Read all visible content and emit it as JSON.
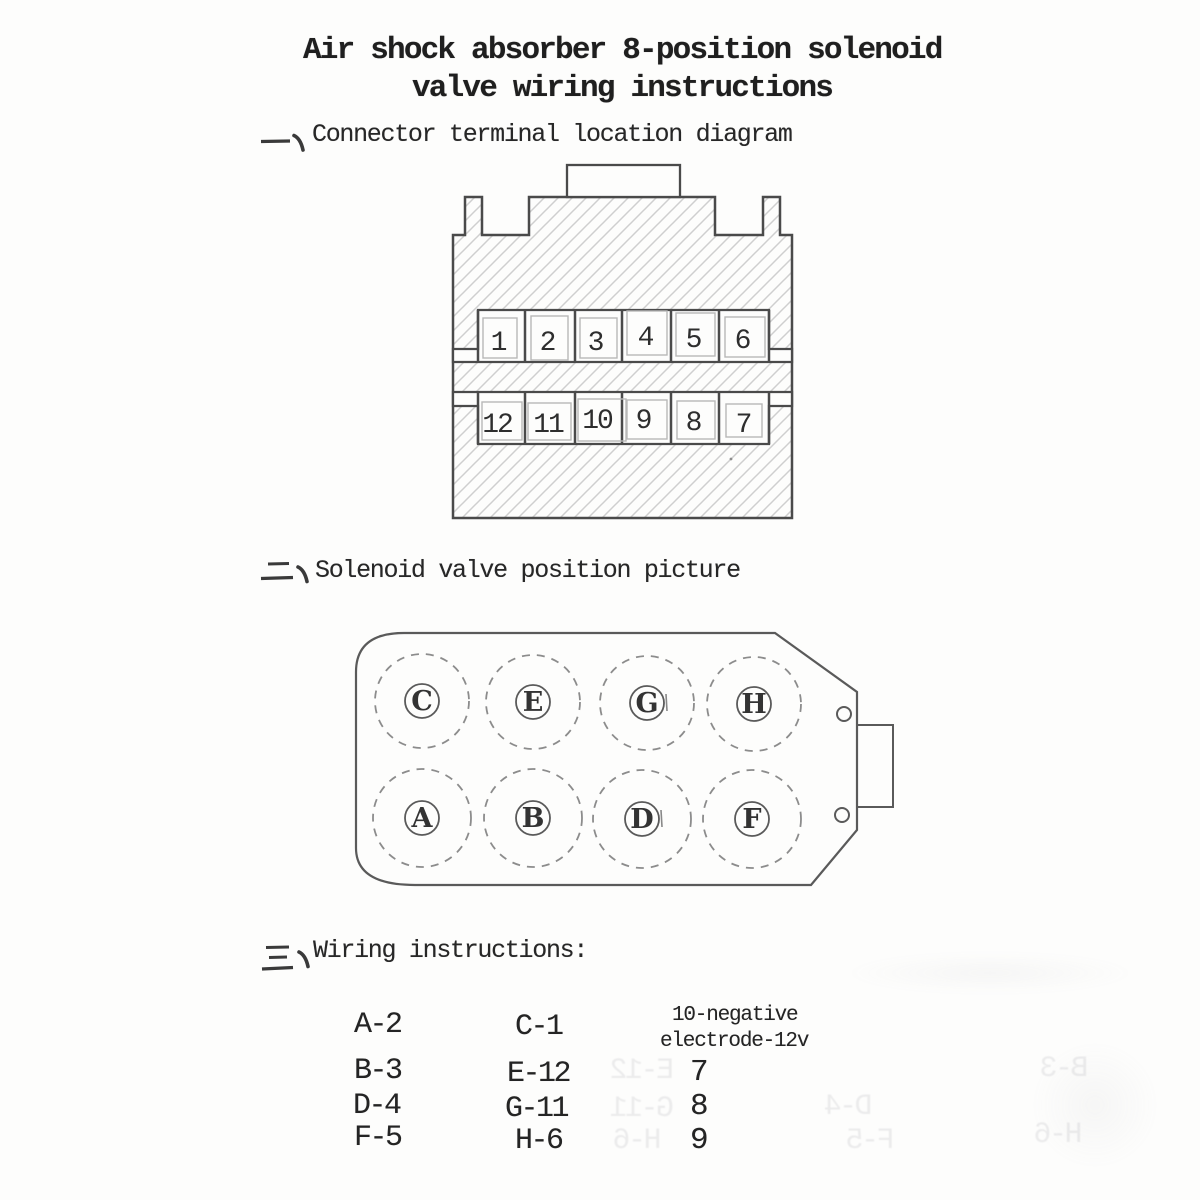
{
  "document": {
    "title_line1": "Air shock absorber 8-position solenoid",
    "title_line2": "valve wiring instructions"
  },
  "sections": {
    "one": {
      "marker": "一、",
      "heading": "Connector terminal location diagram"
    },
    "two": {
      "marker": "二、",
      "heading": "Solenoid valve position picture"
    },
    "three": {
      "marker": "三、",
      "heading": "Wiring instructions:"
    }
  },
  "connector": {
    "top_row": [
      "1",
      "2",
      "3",
      "4",
      "5",
      "6"
    ],
    "bottom_row": [
      "12",
      "11",
      "10",
      "9",
      "8",
      "7"
    ]
  },
  "solenoid": {
    "top_row": [
      "C",
      "E",
      "G",
      "H"
    ],
    "bottom_row": [
      "A",
      "B",
      "D",
      "F"
    ]
  },
  "wiring": {
    "col1": [
      "A-2",
      "B-3",
      "D-4",
      "F-5"
    ],
    "col2": [
      "C-1",
      "E-12",
      "G-11",
      "H-6"
    ],
    "note_line1": "10-negative",
    "note_line2": "electrode-12v",
    "col3": [
      "7",
      "8",
      "9"
    ]
  },
  "artifacts": {
    "bleed": [
      "E-12",
      "G-11",
      "H-6",
      "D-4",
      "F-5",
      "B-3",
      "H-6"
    ]
  },
  "colors": {
    "ink": "#262626",
    "outline": "#4a4a4a",
    "solenoid_outline": "#5a5a5a",
    "hatch": "#cfcfcf",
    "inner_box": "#b8b8b8",
    "paper": "#fdfdfc"
  }
}
